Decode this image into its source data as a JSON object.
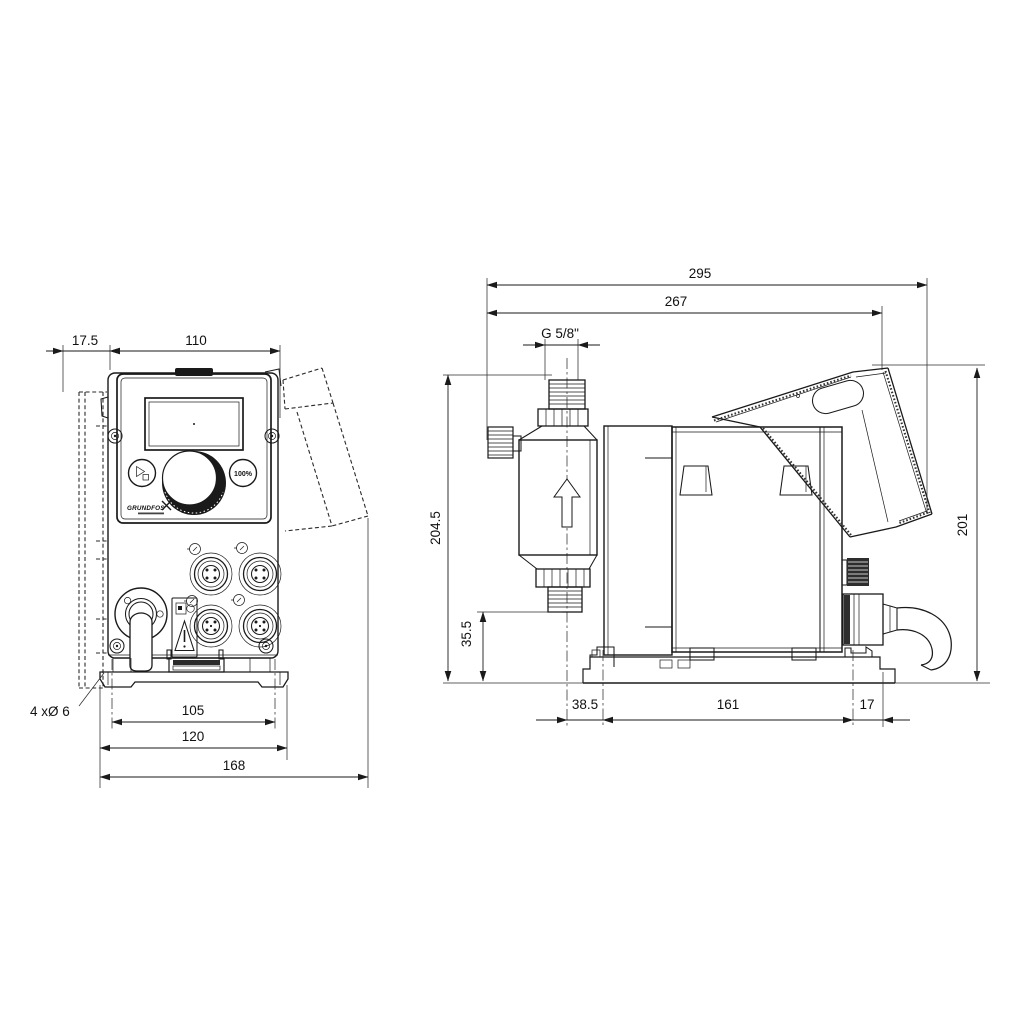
{
  "colors": {
    "line": "#1a1a1a",
    "background": "#ffffff"
  },
  "front_view": {
    "dims": {
      "wall_offset": "17.5",
      "body_width": "110",
      "hole_spacing": "105",
      "plate_width": "120",
      "overall_width": "168",
      "mount_holes": "4 xØ 6"
    },
    "panel": {
      "button_100": "100%",
      "logo": "GRUNDFOS"
    }
  },
  "side_view": {
    "dims": {
      "overall_length": "295",
      "length_to_cover": "267",
      "connection_thread": "G 5/8\"",
      "overall_height": "204.5",
      "valve_height": "35.5",
      "cover_height": "201",
      "base_front_offset": "38.5",
      "mount_hole_spacing": "161",
      "base_rear_offset": "17"
    }
  }
}
